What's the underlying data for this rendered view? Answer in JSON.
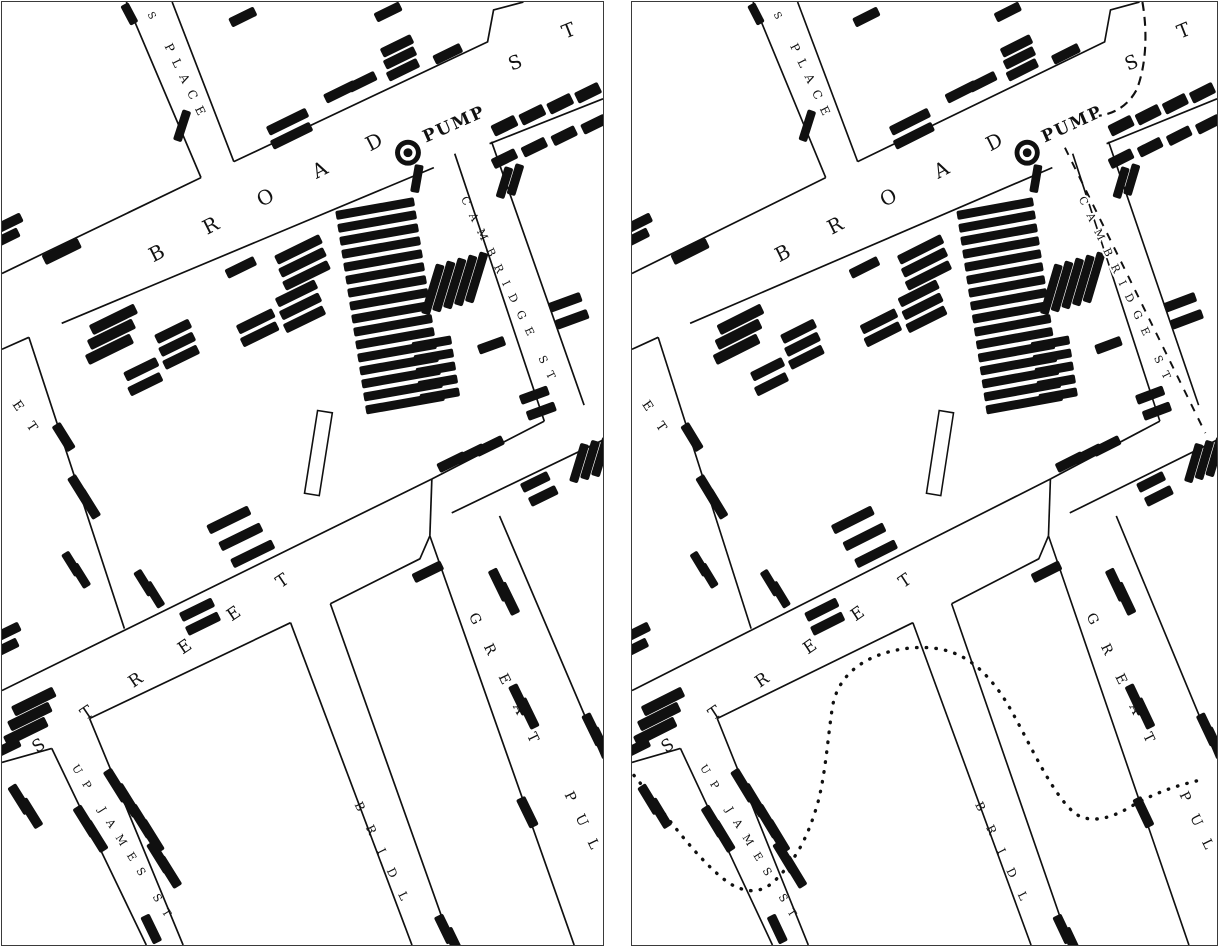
{
  "figure": {
    "kind": "two-panel historical map comparison",
    "paper_color": "#ffffff",
    "ink_color": "#101010",
    "frame_color": "#3a3a3a"
  },
  "panels": [
    {
      "id": "left",
      "name": "original-map",
      "overlays": false
    },
    {
      "id": "right",
      "name": "map-with-boundary-overlay",
      "overlays": true
    }
  ],
  "icons": {
    "pump": "filled-circle-with-ring"
  },
  "map": {
    "pump": {
      "x": 408,
      "y": 151,
      "label": "PUMP"
    },
    "labels": [
      {
        "id": "place-hint-s",
        "t": "S",
        "x": 146,
        "y": 12,
        "r": 62,
        "s": 10,
        "sp": 0
      },
      {
        "id": "place",
        "t": "PLACE",
        "x": 163,
        "y": 44,
        "r": 64,
        "s": 12,
        "sp": 9
      },
      {
        "id": "broad",
        "t": "BROAD",
        "x": 152,
        "y": 261,
        "r": -27,
        "s": 20,
        "sp": 46
      },
      {
        "id": "broad-s",
        "t": "S",
        "x": 512,
        "y": 69,
        "r": -22,
        "s": 19,
        "sp": 0
      },
      {
        "id": "broad-t",
        "t": "T",
        "x": 566,
        "y": 37,
        "r": -22,
        "s": 19,
        "sp": 0
      },
      {
        "id": "pump-label",
        "t": "PUMP",
        "x": 426,
        "y": 141,
        "r": -24,
        "s": 17,
        "sp": 2,
        "b": 1
      },
      {
        "id": "cambridge",
        "t": "CAMBRIDGE ST",
        "x": 461,
        "y": 197,
        "r": 64,
        "s": 11,
        "sp": 10,
        "halo": 1
      },
      {
        "id": "et",
        "t": "ET",
        "x": 10,
        "y": 403,
        "r": 56,
        "s": 13,
        "sp": 16
      },
      {
        "id": "street",
        "t": "STREET",
        "x": 35,
        "y": 753,
        "r": -34,
        "s": 17,
        "sp": 47
      },
      {
        "id": "up-james",
        "t": "UP JAMES ST",
        "x": 70,
        "y": 767,
        "r": 58,
        "s": 11,
        "sp": 10
      },
      {
        "id": "great",
        "t": "GREAT",
        "x": 469,
        "y": 615,
        "r": 64,
        "s": 14,
        "sp": 23
      },
      {
        "id": "pul",
        "t": "PUL",
        "x": 565,
        "y": 794,
        "r": 64,
        "s": 14,
        "sp": 16
      },
      {
        "id": "bridl",
        "t": "BRIDL",
        "x": 354,
        "y": 804,
        "r": 64,
        "s": 12,
        "sp": 17
      }
    ],
    "street_format": "polyline points [x,y]",
    "streets": [
      [
        [
          0,
          272
        ],
        [
          200,
          176
        ]
      ],
      [
        [
          233,
          160
        ],
        [
          488,
          40
        ],
        [
          494,
          8
        ],
        [
          524,
          0
        ]
      ],
      [
        [
          125,
          0
        ],
        [
          200,
          176
        ]
      ],
      [
        [
          171,
          0
        ],
        [
          233,
          160
        ]
      ],
      [
        [
          0,
          348
        ],
        [
          27,
          336
        ]
      ],
      [
        [
          27,
          336
        ],
        [
          123,
          628
        ]
      ],
      [
        [
          60,
          322
        ],
        [
          434,
          166
        ]
      ],
      [
        [
          490,
          142
        ],
        [
          604,
          97
        ]
      ],
      [
        [
          455,
          152
        ],
        [
          545,
          420
        ]
      ],
      [
        [
          492,
          140
        ],
        [
          585,
          404
        ]
      ],
      [
        [
          545,
          420
        ],
        [
          432,
          478
        ]
      ],
      [
        [
          452,
          512
        ],
        [
          604,
          439
        ]
      ],
      [
        [
          432,
          478
        ],
        [
          430,
          535
        ]
      ],
      [
        [
          430,
          535
        ],
        [
          575,
          945
        ]
      ],
      [
        [
          500,
          515
        ],
        [
          604,
          758
        ]
      ],
      [
        [
          0,
          690
        ],
        [
          432,
          478
        ]
      ],
      [
        [
          0,
          762
        ],
        [
          50,
          748
        ]
      ],
      [
        [
          88,
          718
        ],
        [
          290,
          622
        ]
      ],
      [
        [
          330,
          603
        ],
        [
          420,
          558
        ],
        [
          430,
          535
        ]
      ],
      [
        [
          290,
          622
        ],
        [
          412,
          945
        ]
      ],
      [
        [
          330,
          603
        ],
        [
          452,
          945
        ]
      ],
      [
        [
          50,
          748
        ],
        [
          145,
          945
        ]
      ],
      [
        [
          88,
          718
        ],
        [
          182,
          945
        ]
      ]
    ],
    "building_outline": {
      "x": 318,
      "y": 452,
      "w": 15,
      "h": 84,
      "rot": 9
    },
    "stack_format": "[cx,cy,w,h,rot,count,dx,dy] repeated death bars",
    "death_bar_stacks": [
      [
        375,
        207,
        80,
        9,
        -10,
        16,
        2,
        13
      ],
      [
        432,
        342,
        40,
        9,
        -10,
        5,
        2,
        13
      ],
      [
        298,
        248,
        50,
        10,
        -26,
        3,
        4,
        13
      ],
      [
        296,
        292,
        44,
        10,
        -26,
        3,
        4,
        13
      ],
      [
        240,
        266,
        32,
        10,
        -26,
        1,
        0,
        0
      ],
      [
        255,
        320,
        40,
        10,
        -26,
        2,
        4,
        13
      ],
      [
        172,
        330,
        38,
        10,
        -26,
        3,
        4,
        13
      ],
      [
        112,
        318,
        50,
        11,
        -26,
        3,
        -2,
        15
      ],
      [
        140,
        368,
        36,
        10,
        -26,
        2,
        4,
        15
      ],
      [
        60,
        250,
        40,
        11,
        -26,
        1,
        0,
        0
      ],
      [
        8,
        221,
        26,
        10,
        -26,
        2,
        -3,
        15
      ],
      [
        287,
        120,
        44,
        10,
        -26,
        2,
        4,
        14
      ],
      [
        340,
        90,
        34,
        10,
        -26,
        1,
        0,
        0
      ],
      [
        362,
        80,
        30,
        10,
        -26,
        1,
        0,
        0
      ],
      [
        397,
        44,
        34,
        10,
        -26,
        3,
        3,
        12
      ],
      [
        448,
        52,
        30,
        10,
        -26,
        1,
        0,
        0
      ],
      [
        388,
        10,
        28,
        10,
        -26,
        1,
        0,
        0
      ],
      [
        242,
        15,
        28,
        10,
        -26,
        1,
        0,
        0
      ],
      [
        128,
        12,
        22,
        9,
        62,
        1,
        0,
        0
      ],
      [
        181,
        124,
        9,
        32,
        18,
        1,
        0,
        0
      ],
      [
        505,
        157,
        26,
        11,
        -26,
        4,
        30,
        -11.5
      ],
      [
        505,
        124,
        26,
        12,
        -26,
        4,
        28,
        -11
      ],
      [
        433,
        288,
        9,
        52,
        17,
        5,
        11,
        -3
      ],
      [
        505,
        181,
        9,
        32,
        17,
        2,
        11,
        -3
      ],
      [
        566,
        301,
        34,
        10,
        -20,
        2,
        7,
        17
      ],
      [
        535,
        394,
        30,
        10,
        -20,
        2,
        7,
        16
      ],
      [
        492,
        344,
        28,
        10,
        -20,
        1,
        0,
        0
      ],
      [
        417,
        177,
        9,
        28,
        10,
        1,
        0,
        0
      ],
      [
        32,
        701,
        46,
        11,
        -26,
        3,
        -4,
        15
      ],
      [
        6,
        747,
        26,
        10,
        -26,
        1,
        0,
        0
      ],
      [
        6,
        631,
        26,
        10,
        -26,
        2,
        -2,
        16
      ],
      [
        62,
        436,
        30,
        10,
        58,
        1,
        0,
        0
      ],
      [
        78,
        489,
        32,
        10,
        58,
        2,
        9,
        14
      ],
      [
        70,
        563,
        26,
        9,
        58,
        2,
        9,
        12
      ],
      [
        228,
        519,
        46,
        10,
        -26,
        3,
        12,
        17
      ],
      [
        143,
        582,
        28,
        9,
        58,
        2,
        10,
        12
      ],
      [
        196,
        609,
        36,
        10,
        -26,
        2,
        6,
        14
      ],
      [
        18,
        799,
        32,
        10,
        58,
        2,
        11,
        14
      ],
      [
        115,
        785,
        36,
        10,
        58,
        2,
        11,
        15
      ],
      [
        140,
        821,
        36,
        10,
        58,
        2,
        10,
        15
      ],
      [
        158,
        857,
        34,
        10,
        58,
        2,
        10,
        15
      ],
      [
        84,
        821,
        34,
        10,
        58,
        2,
        10,
        15
      ],
      [
        452,
        461,
        30,
        10,
        -26,
        3,
        19,
        -8
      ],
      [
        500,
        584,
        34,
        10,
        64,
        2,
        9,
        14
      ],
      [
        520,
        699,
        32,
        10,
        64,
        2,
        9,
        14
      ],
      [
        528,
        812,
        32,
        10,
        64,
        1,
        0,
        0
      ],
      [
        580,
        462,
        9,
        40,
        17,
        3,
        11,
        -3
      ],
      [
        536,
        481,
        30,
        10,
        -26,
        2,
        8,
        14
      ],
      [
        594,
        729,
        34,
        10,
        64,
        2,
        8,
        14
      ],
      [
        428,
        571,
        32,
        10,
        -26,
        1,
        0,
        0
      ],
      [
        445,
        929,
        30,
        10,
        64,
        2,
        9,
        13
      ],
      [
        150,
        929,
        30,
        10,
        64,
        1,
        0,
        0
      ]
    ],
    "overlays": {
      "dotted_boundary_path": "M 2 775 C 30 808, 70 864, 102 884 C 120 894, 136 893, 150 878 C 170 858, 182 836, 192 802 C 200 772, 202 738, 207 706 C 214 668, 250 650, 292 647 C 332 645, 356 660, 380 692 C 402 722, 428 788, 456 812 C 470 823, 490 820, 512 808 C 538 793, 562 785, 590 779",
      "dashed_arc_path": "M 527 0 C 533 34, 530 66, 521 88 C 512 104, 498 112, 482 114",
      "dashed_street_path": "M 447 146 L 592 432"
    }
  }
}
